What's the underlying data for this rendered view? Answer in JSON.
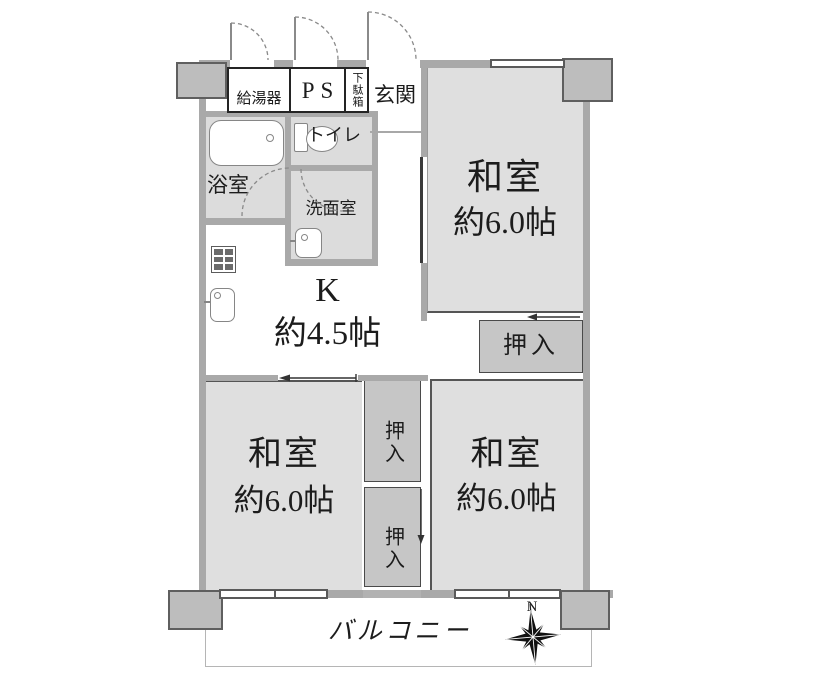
{
  "colors": {
    "background": "#ffffff",
    "wall": "#a9a9a9",
    "room_fill": "#dfdfdf",
    "wet_area_fill": "#dcdcdc",
    "closet_fill": "#c6c6c6",
    "pillar_fill": "#bdbdbd",
    "line": "#3a3a3a"
  },
  "labels": {
    "water_heater": "給湯器",
    "pipe_space": "PS",
    "shoe_cabinet": "下駄箱",
    "entrance": "玄関",
    "bathroom": "浴室",
    "toilet": "トイレ",
    "washroom": "洗面室",
    "closet": "押入",
    "balcony": "バルコニー",
    "compass_north": "N"
  },
  "kitchen": {
    "name": "K",
    "size": "約4.5帖"
  },
  "rooms": [
    {
      "name": "和室",
      "size": "約6.0帖"
    },
    {
      "name": "和室",
      "size": "約6.0帖"
    },
    {
      "name": "和室",
      "size": "約6.0帖"
    }
  ]
}
